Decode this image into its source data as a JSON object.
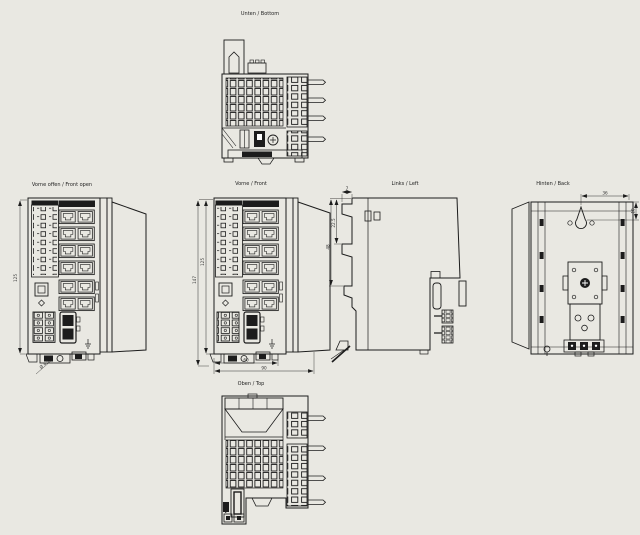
{
  "drawing": {
    "background": "#e9e8e2",
    "ink": "#1c1c1c",
    "views": {
      "bottom": {
        "label": "Unten / Bottom"
      },
      "front_open": {
        "label": "Vorne offen / Front open",
        "dims": {
          "height": "125",
          "hole": "Ø 4,5"
        }
      },
      "front": {
        "label": "Vorne / Front",
        "dims": {
          "height_outer": "147",
          "height_inner": "125",
          "width_body": "60",
          "width_total": "90"
        }
      },
      "left": {
        "label": "Links / Left",
        "dims": {
          "hook_width": "7",
          "hook_offset": "22.5",
          "hook_pitch": "48"
        }
      },
      "back": {
        "label": "Hinten / Back",
        "dims": {
          "keyhole_offset": "36",
          "keyhole_drop": "10"
        }
      },
      "top": {
        "label": "Oben / Top"
      }
    }
  }
}
